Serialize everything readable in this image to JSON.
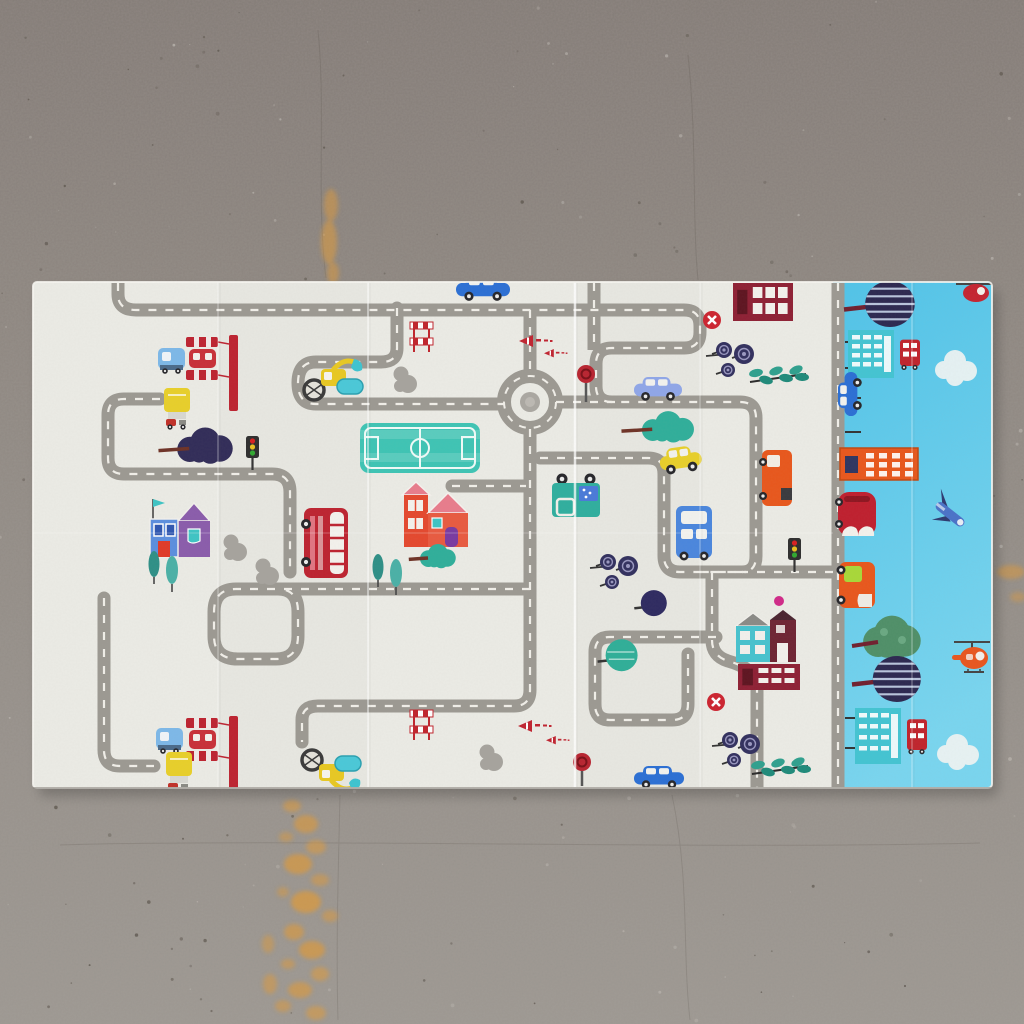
{
  "scene": {
    "subject": "foldable children's play mat with road-map city print",
    "setting": "top-down view on gray speckled concrete floor with orange paint stains",
    "no_text_visible": true
  },
  "palette": {
    "floor_top": "#847c77",
    "floor_mid": "#8e8781",
    "floor_bottom": "#9d9892",
    "speckle_dark": "#5e574f",
    "speckle_light": "#b9b4ae",
    "stain_orange": "#e09a38",
    "mat_white": "#ebebe5",
    "mat_blue_1": "#50c3e8",
    "mat_blue_2": "#79d5ef",
    "road_gray": "#9c9992",
    "road_dash": "#f1efe9",
    "red": "#bd2330",
    "teal": "#2fae9a",
    "teal_light": "#43c4d2",
    "yellow": "#e8cf2a",
    "orange": "#e8571c",
    "navy": "#2e2a56",
    "purple": "#8a5cab",
    "blue_car": "#2b6fd4",
    "periwinkle": "#8fa6e8",
    "maroon": "#8e2034",
    "green_tree": "#4f8f68"
  },
  "mat": {
    "x": 33,
    "y": 282,
    "w": 959,
    "h": 506,
    "split_x": 833,
    "corner_radius": 4,
    "creases_vertical": [
      {
        "x": 218,
        "o": 0.3,
        "w": 1.5
      },
      {
        "x": 368,
        "o": 0.45,
        "w": 2
      },
      {
        "x": 575,
        "o": 0.75,
        "w": 2.5
      },
      {
        "x": 700,
        "o": 0.28,
        "w": 1.5
      },
      {
        "x": 912,
        "o": 0.3,
        "w": 1.5
      }
    ],
    "crease_horizontal": {
      "y": 533,
      "o": 0.18
    },
    "shadow_opacity": 0.22
  },
  "roads": {
    "width": 13,
    "dash_width": 2.2,
    "dash_array": "8 9",
    "paths": [
      {
        "d": "M118,283 V294 Q118,310 136,310 H684 Q700,310 700,326 V332 Q700,348 684,348 H612 Q596,348 596,364 V386 Q596,402 612,402 H740 Q756,402 756,418 V556 Q756,572 742,572 H700",
        "cap": "butt"
      },
      {
        "d": "M594,283 V350",
        "cap": "butt"
      },
      {
        "d": "M833,572 H742",
        "cap": "butt"
      },
      {
        "d": "M397,308 V348 Q397,362 381,362 H316 Q298,362 298,383 Q298,404 316,404 H504",
        "cap": "round"
      },
      {
        "d": "M556,402 H618",
        "cap": "round"
      },
      {
        "d": "M530,310 V375",
        "cap": "butt"
      },
      {
        "d": "M530,429 V690 Q530,706 514,706 H318 Q302,706 302,720 V742",
        "cap": "round"
      },
      {
        "d": "M160,399 H124 Q108,399 108,415 V458 Q108,474 124,474 H272 Q290,474 290,492 V572",
        "cap": "round"
      },
      {
        "d": "M530,589 H236 Q214,589 214,612 V636 Q214,659 238,659 H276 Q298,659 298,636 V612 Q298,589 278,589",
        "cap": "round"
      },
      {
        "d": "M104,598 V750 Q104,766 120,766 H154",
        "cap": "round"
      },
      {
        "d": "M452,486 H526",
        "cap": "round"
      },
      {
        "d": "M540,458 H648 Q664,458 664,474 V556 Q664,572 680,572 H746",
        "cap": "round"
      },
      {
        "d": "M712,572 V640 Q712,656 728,661 Q757,669 757,688 V788",
        "cap": "butt"
      },
      {
        "d": "M716,637 H610 Q595,637 595,652 V704 Q595,720 610,720 H672 Q688,720 688,704 V654",
        "cap": "round"
      },
      {
        "d": "M838,283 V788",
        "cap": "butt"
      }
    ],
    "roundabout": {
      "cx": 530,
      "cy": 402,
      "r": 26,
      "inner_r": 10
    }
  },
  "white_objects": [
    {
      "t": "station",
      "x": 186,
      "y": 335
    },
    {
      "t": "btruck",
      "x": 158,
      "y": 346
    },
    {
      "t": "ytruck",
      "x": 164,
      "y": 388
    },
    {
      "t": "treeblob",
      "x": 170,
      "y": 432,
      "w": 64,
      "h": 30,
      "c": "#312c58"
    },
    {
      "t": "light",
      "x": 246,
      "y": 436
    },
    {
      "t": "housepurple",
      "x": 150,
      "y": 497
    },
    {
      "t": "cypress",
      "x": 146,
      "y": 552
    },
    {
      "t": "bush",
      "x": 224,
      "y": 534
    },
    {
      "t": "bush",
      "x": 256,
      "y": 558
    },
    {
      "t": "dbus",
      "x": 304,
      "y": 508
    },
    {
      "t": "excavator",
      "x": 302,
      "y": 356
    },
    {
      "t": "bush",
      "x": 394,
      "y": 366
    },
    {
      "t": "barrier",
      "x": 410,
      "y": 318
    },
    {
      "t": "cone",
      "x": 519,
      "y": 335,
      "s": 1
    },
    {
      "t": "cone",
      "x": 544,
      "y": 349,
      "s": 0.7
    },
    {
      "t": "field",
      "x": 360,
      "y": 423
    },
    {
      "t": "housered",
      "x": 404,
      "y": 485
    },
    {
      "t": "treeblob",
      "x": 416,
      "y": 547,
      "w": 40,
      "h": 20,
      "c": "#2fae9a"
    },
    {
      "t": "tealtruck",
      "x": 552,
      "y": 475
    },
    {
      "t": "stopsign",
      "x": 586,
      "y": 366,
      "h": 36
    },
    {
      "t": "car",
      "x": 634,
      "y": 377,
      "w": 48,
      "h": 22,
      "body": "#8fa6e8"
    },
    {
      "t": "lollipop",
      "x": 714,
      "y": 340
    },
    {
      "t": "leafy",
      "x": 750,
      "y": 368
    },
    {
      "t": "treeblob",
      "x": 633,
      "y": 415,
      "w": 64,
      "h": 26,
      "c": "#2fae9a"
    },
    {
      "t": "car",
      "x": 658,
      "y": 450,
      "w": 42,
      "h": 24,
      "body": "#e8cf2a",
      "rot": -8
    },
    {
      "t": "otruck",
      "x": 762,
      "y": 450
    },
    {
      "t": "gridbldg",
      "x": 733,
      "y": 283,
      "w": 60,
      "h": 38
    },
    {
      "t": "noentry",
      "x": 712,
      "y": 320
    },
    {
      "t": "bus",
      "x": 676,
      "y": 506
    },
    {
      "t": "light",
      "x": 788,
      "y": 538
    },
    {
      "t": "car",
      "x": 456,
      "y": 276,
      "w": 54,
      "h": 23,
      "body": "#2b6fd4"
    },
    {
      "t": "housetm",
      "x": 736,
      "y": 610
    },
    {
      "t": "gridbldg",
      "x": 738,
      "y": 664,
      "w": 62,
      "h": 26
    },
    {
      "t": "noentry",
      "x": 716,
      "y": 702
    },
    {
      "t": "lollipop",
      "x": 720,
      "y": 730
    },
    {
      "t": "leafy",
      "x": 752,
      "y": 760
    },
    {
      "t": "dot",
      "x": 779,
      "y": 601,
      "r": 5,
      "c": "#d02a88"
    },
    {
      "t": "station",
      "x": 186,
      "y": 716
    },
    {
      "t": "btruck",
      "x": 156,
      "y": 726
    },
    {
      "t": "ytruck",
      "x": 166,
      "y": 752
    },
    {
      "t": "excavator",
      "x": 300,
      "y": 748,
      "flip": 1,
      "h": 46
    },
    {
      "t": "barrier",
      "x": 410,
      "y": 706
    },
    {
      "t": "cone",
      "x": 518,
      "y": 720,
      "s": 1
    },
    {
      "t": "cone",
      "x": 546,
      "y": 736,
      "s": 0.7
    },
    {
      "t": "stopsign",
      "x": 582,
      "y": 754,
      "h": 32
    },
    {
      "t": "car",
      "x": 634,
      "y": 766,
      "w": 50,
      "h": 21,
      "body": "#2b6fd4"
    },
    {
      "t": "lollipop",
      "x": 598,
      "y": 552
    },
    {
      "t": "treeball",
      "x": 646,
      "y": 594,
      "c": "#2e2a60",
      "r": 13
    },
    {
      "t": "treeball",
      "x": 612,
      "y": 644,
      "c": "#2fae98",
      "r": 16,
      "lines": 1
    },
    {
      "t": "bush",
      "x": 480,
      "y": 744
    },
    {
      "t": "cypress",
      "x": 370,
      "y": 555
    }
  ],
  "blue_objects": [
    {
      "t": "stripetree",
      "x": 854,
      "y": 281,
      "w": 62,
      "h": 46
    },
    {
      "t": "tealbldg",
      "x": 848,
      "y": 330,
      "h": 48
    },
    {
      "t": "cloud",
      "x": 934,
      "y": 350
    },
    {
      "t": "vcar",
      "x": 838,
      "y": 394,
      "w": 44,
      "h": 22,
      "body": "#2b6fd4"
    },
    {
      "t": "orangebldg",
      "x": 840,
      "y": 448
    },
    {
      "t": "redcar2",
      "x": 838,
      "y": 492
    },
    {
      "t": "plane",
      "x": 948,
      "y": 512
    },
    {
      "t": "helired",
      "x": 968,
      "y": 281
    },
    {
      "t": "gtruck",
      "x": 839,
      "y": 556
    },
    {
      "t": "fluffgreen",
      "x": 858,
      "y": 620
    },
    {
      "t": "stripetree",
      "x": 862,
      "y": 656,
      "w": 60,
      "h": 46
    },
    {
      "t": "tealbldg",
      "x": 855,
      "y": 708,
      "h": 56
    },
    {
      "t": "cloud",
      "x": 936,
      "y": 734
    },
    {
      "t": "heliorange",
      "x": 968,
      "y": 640
    }
  ],
  "blue_ticks": [
    [
      845,
      342
    ],
    [
      845,
      368
    ],
    [
      845,
      398
    ],
    [
      845,
      432
    ],
    [
      845,
      718
    ],
    [
      845,
      748
    ]
  ],
  "floor_cracks": [
    "M318,30 C326,110 316,200 326,278",
    "M688,55 C697,140 692,215 698,280",
    "M340,795 C338,880 336,950 338,1020",
    "M672,795 C690,880 682,950 690,1020",
    "M60,845 C300,838 700,850 980,843"
  ],
  "floor_stains": [
    {
      "x": 331,
      "y": 205,
      "rx": 7,
      "ry": 16,
      "o": 0.5
    },
    {
      "x": 329,
      "y": 242,
      "rx": 8,
      "ry": 22,
      "o": 0.55
    },
    {
      "x": 333,
      "y": 273,
      "rx": 6,
      "ry": 11,
      "o": 0.5
    },
    {
      "x": 1011,
      "y": 572,
      "rx": 14,
      "ry": 7,
      "o": 0.5
    },
    {
      "x": 1018,
      "y": 597,
      "rx": 8,
      "ry": 5,
      "o": 0.4
    },
    {
      "x": 292,
      "y": 806,
      "rx": 9,
      "ry": 6,
      "o": 0.55
    },
    {
      "x": 306,
      "y": 824,
      "rx": 12,
      "ry": 9,
      "o": 0.6
    },
    {
      "x": 286,
      "y": 837,
      "rx": 7,
      "ry": 5,
      "o": 0.45
    },
    {
      "x": 316,
      "y": 847,
      "rx": 10,
      "ry": 7,
      "o": 0.55
    },
    {
      "x": 298,
      "y": 864,
      "rx": 14,
      "ry": 10,
      "o": 0.65
    },
    {
      "x": 320,
      "y": 880,
      "rx": 9,
      "ry": 6,
      "o": 0.5
    },
    {
      "x": 283,
      "y": 892,
      "rx": 6,
      "ry": 5,
      "o": 0.45
    },
    {
      "x": 306,
      "y": 902,
      "rx": 15,
      "ry": 11,
      "o": 0.7
    },
    {
      "x": 330,
      "y": 916,
      "rx": 8,
      "ry": 6,
      "o": 0.5
    },
    {
      "x": 294,
      "y": 932,
      "rx": 10,
      "ry": 8,
      "o": 0.6
    },
    {
      "x": 312,
      "y": 950,
      "rx": 13,
      "ry": 9,
      "o": 0.65
    },
    {
      "x": 288,
      "y": 964,
      "rx": 7,
      "ry": 5,
      "o": 0.5
    },
    {
      "x": 320,
      "y": 974,
      "rx": 9,
      "ry": 7,
      "o": 0.55
    },
    {
      "x": 300,
      "y": 990,
      "rx": 12,
      "ry": 8,
      "o": 0.6
    },
    {
      "x": 283,
      "y": 1006,
      "rx": 8,
      "ry": 6,
      "o": 0.5
    },
    {
      "x": 316,
      "y": 1013,
      "rx": 10,
      "ry": 7,
      "o": 0.55
    },
    {
      "x": 268,
      "y": 944,
      "rx": 6,
      "ry": 9,
      "o": 0.45
    },
    {
      "x": 270,
      "y": 984,
      "rx": 7,
      "ry": 10,
      "o": 0.5
    }
  ]
}
